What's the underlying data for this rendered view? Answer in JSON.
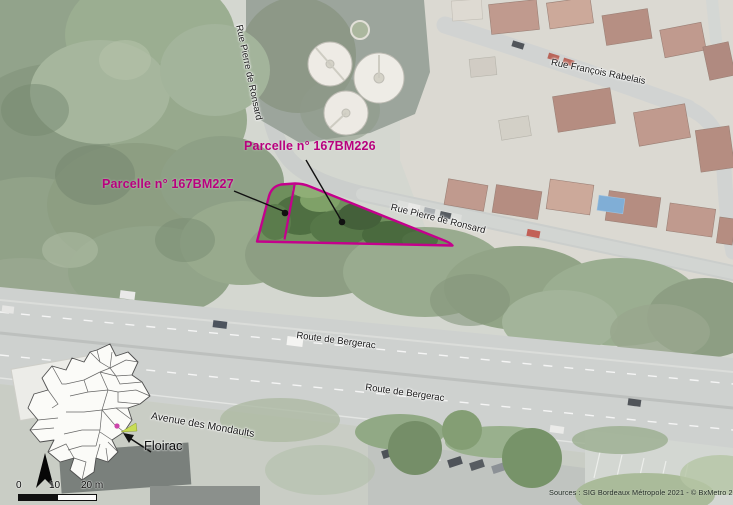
{
  "parcels": {
    "p227": {
      "label": "Parcelle n° 167BM227"
    },
    "p226": {
      "label": "Parcelle n° 167BM226"
    }
  },
  "streets": {
    "ronsard_vertical": "Rue Pierre de Ronsard",
    "rabelais": "Rue François Rabelais",
    "ronsard_diagonal": "Rue Pierre de Ronsard",
    "bergerac_upper": "Route de Bergerac",
    "bergerac_lower": "Route de Bergerac",
    "mondaults": "Avenue des Mondaults"
  },
  "inset_map": {
    "place_label": "Floirac"
  },
  "scale_bar": {
    "tick_0": "0",
    "tick_10": "10",
    "tick_20": "20 m"
  },
  "attribution": "Sources : SIG Bordeaux Métropole 2021 - © BxMetro 2020.",
  "colors": {
    "parcel_outline": "#c4008c",
    "parcel_label": "#b8007e",
    "marker_dot": "#cc44aa"
  }
}
